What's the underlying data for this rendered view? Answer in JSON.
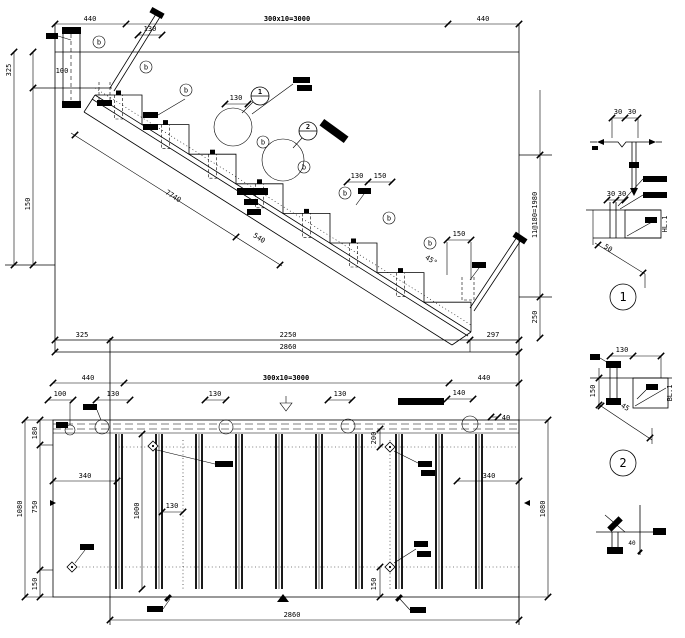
{
  "drawing": {
    "type": "stair structural detail drawing",
    "line_color": "#000000",
    "background": "#ffffff"
  },
  "top_view": {
    "marker_letter": "b",
    "callout_1": "1",
    "callout_2": "2",
    "dims": {
      "top_l": "440",
      "top_m": "300x10=3000",
      "top_r": "440",
      "left_325": "325",
      "left_100": "100",
      "left_150": "150",
      "d130a": "130",
      "d130b": "130",
      "d130c": "130",
      "d150m": "150",
      "d150r": "150",
      "bot_325": "325",
      "bot_2250": "2250",
      "bot_297": "297",
      "bot_total": "2860",
      "right_formula": "11@180=1980",
      "right_250": "250",
      "slope_7740": "7740",
      "slope_540": "540",
      "ang_45": "45°"
    }
  },
  "plan_view": {
    "dims": {
      "top_l": "440",
      "top_m": "300x10=3000",
      "top_r": "440",
      "t_100": "100",
      "t_130a": "130",
      "t_130b": "130",
      "t_130c": "130",
      "t_140": "140",
      "t_40": "40",
      "l_180": "180",
      "l_750": "750",
      "l_150": "150",
      "l_total": "1080",
      "i_1000": "1000",
      "i_130": "130",
      "i_200": "200",
      "i_340l": "340",
      "i_340r": "340",
      "i_150": "150",
      "r_total": "1080",
      "bot_total": "2860"
    }
  },
  "details": {
    "d1": {
      "num": "1",
      "tag": "HL.1",
      "d30a": "30",
      "d30b": "30",
      "d50": "50"
    },
    "d2": {
      "num": "2",
      "tag": "BL.1",
      "d130": "130",
      "d150": "150",
      "d45": "45"
    },
    "top_sketch": {
      "d30a": "30",
      "d30b": "30"
    },
    "bottom_sketch": {
      "d40": "40"
    }
  }
}
